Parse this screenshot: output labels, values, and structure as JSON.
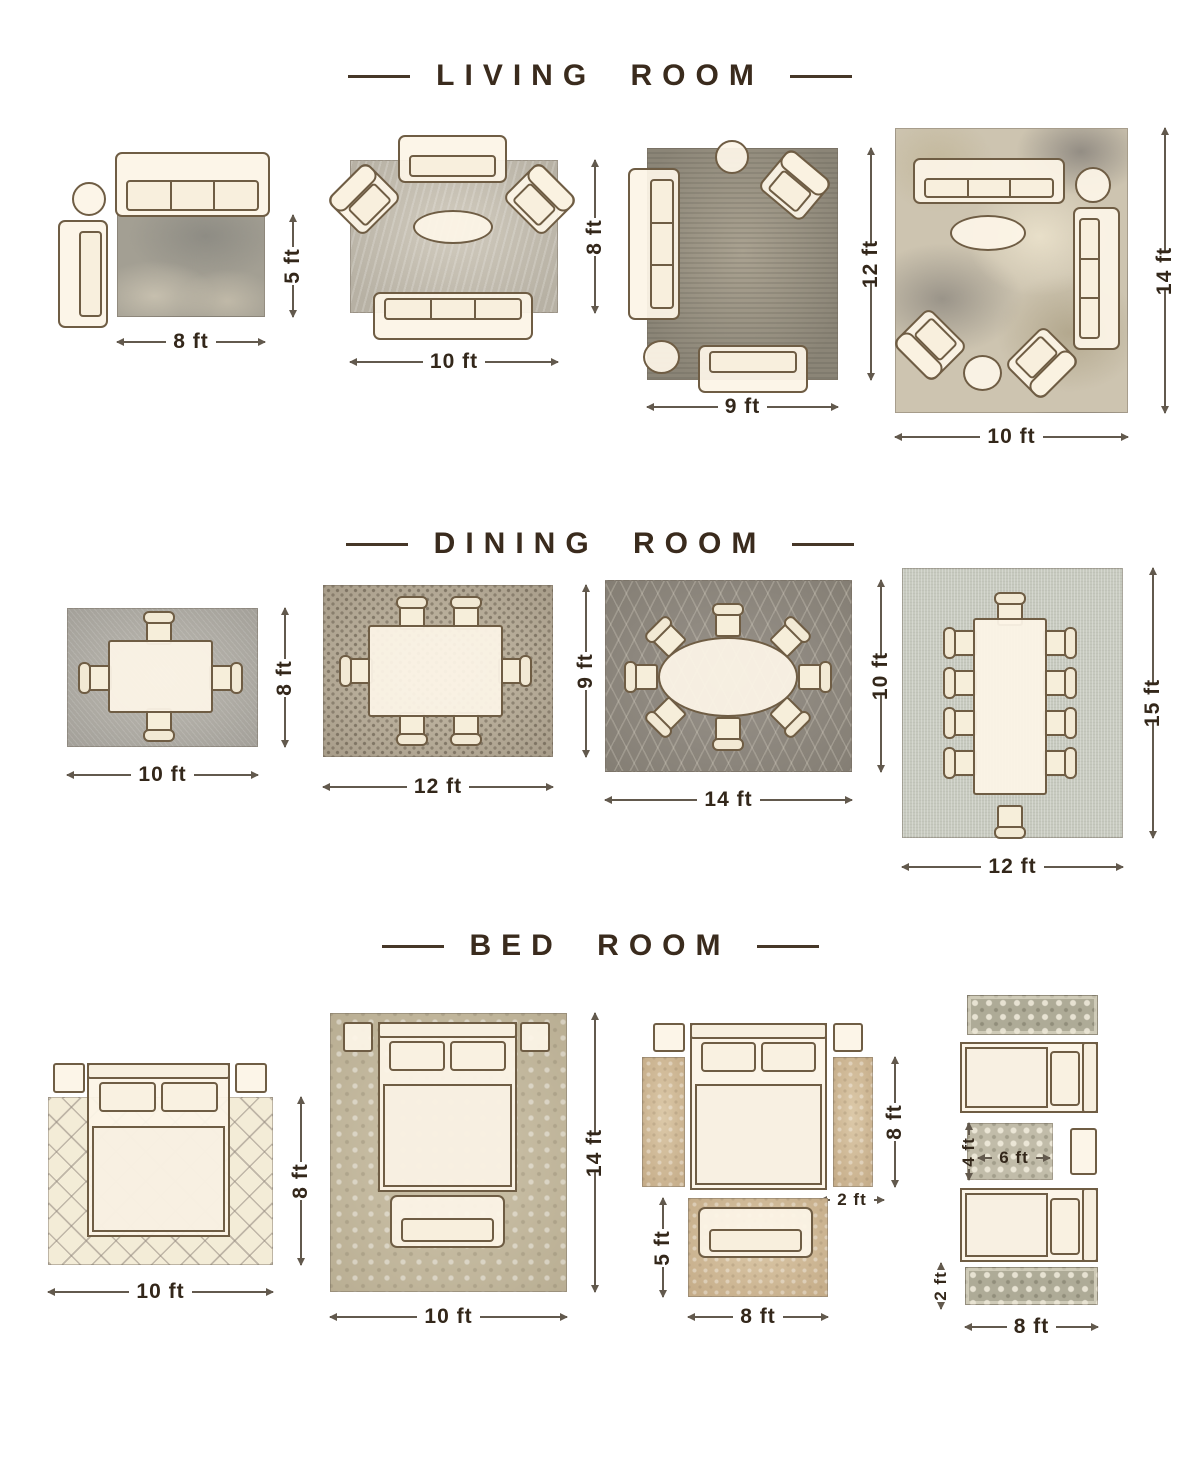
{
  "sections": [
    {
      "title": "LIVING ROOM",
      "layouts": [
        {
          "bottom": "8 ft",
          "side": "5 ft"
        },
        {
          "bottom": "10 ft",
          "side": "8 ft"
        },
        {
          "bottom": "9 ft",
          "side": "12 ft"
        },
        {
          "bottom": "10 ft",
          "side": "14 ft"
        }
      ]
    },
    {
      "title": "DINING ROOM",
      "layouts": [
        {
          "bottom": "10 ft",
          "side": "8 ft"
        },
        {
          "bottom": "12 ft",
          "side": "9 ft"
        },
        {
          "bottom": "14 ft",
          "side": "10 ft"
        },
        {
          "bottom": "12 ft",
          "side": "15 ft"
        }
      ]
    },
    {
      "title": "BED ROOM",
      "layouts": [
        {
          "bottom": "10 ft",
          "side": "8 ft"
        },
        {
          "bottom": "10 ft",
          "side": "14 ft"
        },
        {
          "bottom": "8 ft",
          "side": "8 ft",
          "runner_width": "2 ft",
          "rug_height": "5 ft"
        },
        {
          "bottom": "8 ft",
          "rug_height": "4 ft",
          "rug_width": "6 ft",
          "runner_height": "2 ft"
        }
      ]
    }
  ]
}
